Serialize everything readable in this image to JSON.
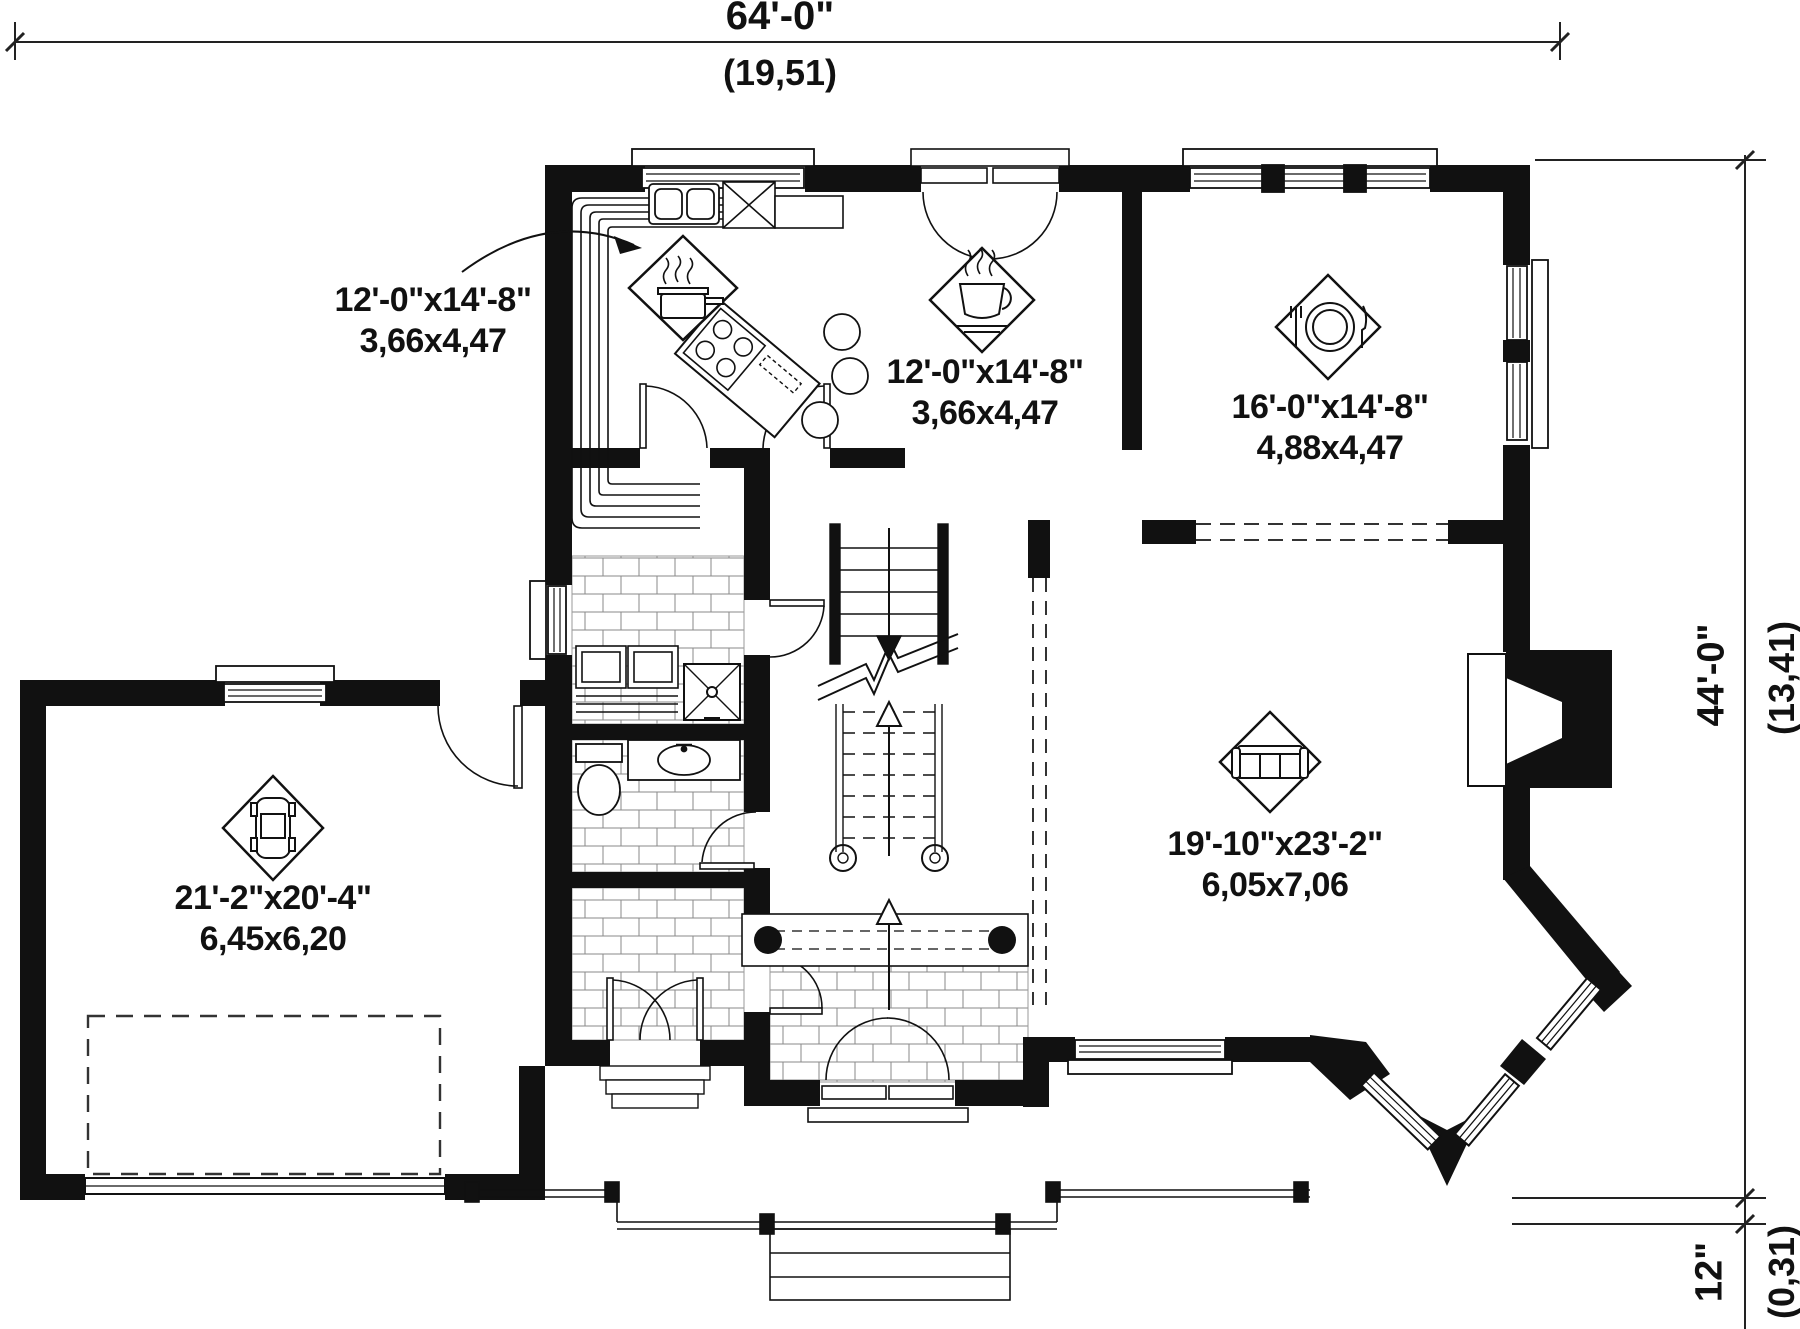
{
  "plan": {
    "type": "first-floor-plan",
    "dimensions": {
      "top": {
        "imperial": "64'-0\"",
        "metric": "(19,51)"
      },
      "right": {
        "imperial": "44'-0\"",
        "metric": "(13,41)"
      },
      "porch": {
        "imperial": "12\"",
        "metric": "(0,31)"
      }
    },
    "rooms": [
      {
        "id": "kitchen",
        "imperial": "12'-0\"x14'-8\"",
        "metric": "3,66x4,47",
        "icon": "cooking-pot-icon"
      },
      {
        "id": "breakfast",
        "imperial": "12'-0\"x14'-8\"",
        "metric": "3,66x4,47",
        "icon": "coffee-cup-icon"
      },
      {
        "id": "dining",
        "imperial": "16'-0\"x14'-8\"",
        "metric": "4,88x4,47",
        "icon": "plate-cutlery-icon"
      },
      {
        "id": "garage",
        "imperial": "21'-2\"x20'-4\"",
        "metric": "6,45x6,20",
        "icon": "car-icon"
      },
      {
        "id": "living",
        "imperial": "19'-10\"x23'-2\"",
        "metric": "6,05x7,06",
        "icon": "sofa-icon"
      }
    ]
  }
}
